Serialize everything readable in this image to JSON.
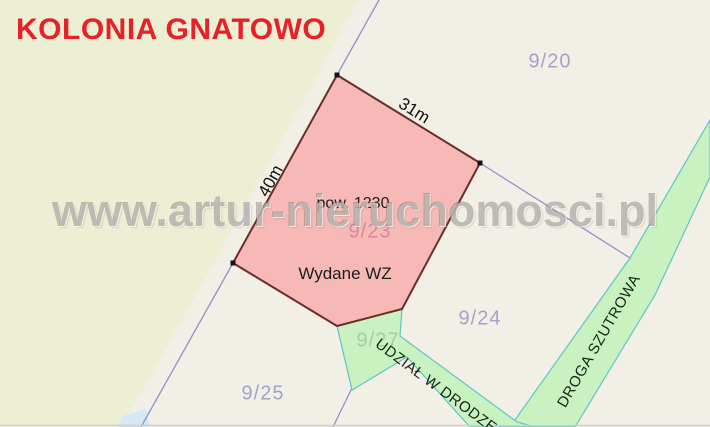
{
  "map": {
    "area_title": "KOLONIA GNATOWO",
    "watermark": "www.artur-nieruchomosci.pl"
  },
  "highlighted_plot": {
    "parcel_number": "9/23",
    "area_label": "pow. 1230",
    "decision_label": "Wydane WZ",
    "edge_top_length": "31m",
    "edge_left_length": "40m"
  },
  "parcels": [
    {
      "label": "9/20"
    },
    {
      "label": "9/24"
    },
    {
      "label": "9/25"
    },
    {
      "label": "9/27"
    }
  ],
  "roads": [
    {
      "label": "DROGA SZUTROWA"
    },
    {
      "label": "UDZIAŁ W DRODZE"
    }
  ],
  "colors": {
    "title_red": "#e82028",
    "background_cream": "#f2efe7",
    "area_yellow_green": "#edefd5",
    "plot_fill": "#f6b9b5",
    "plot_border": "#6d2c2c",
    "road_green_fill": "#c9f2c0",
    "road_green_border": "#5ec6c6",
    "boundary_purple": "#9191ca",
    "vertex_black": "#141414",
    "water_blue": "#d6e8f4",
    "edge_gray": "#d2d0c9",
    "watermark_gray": "#7d7870"
  }
}
